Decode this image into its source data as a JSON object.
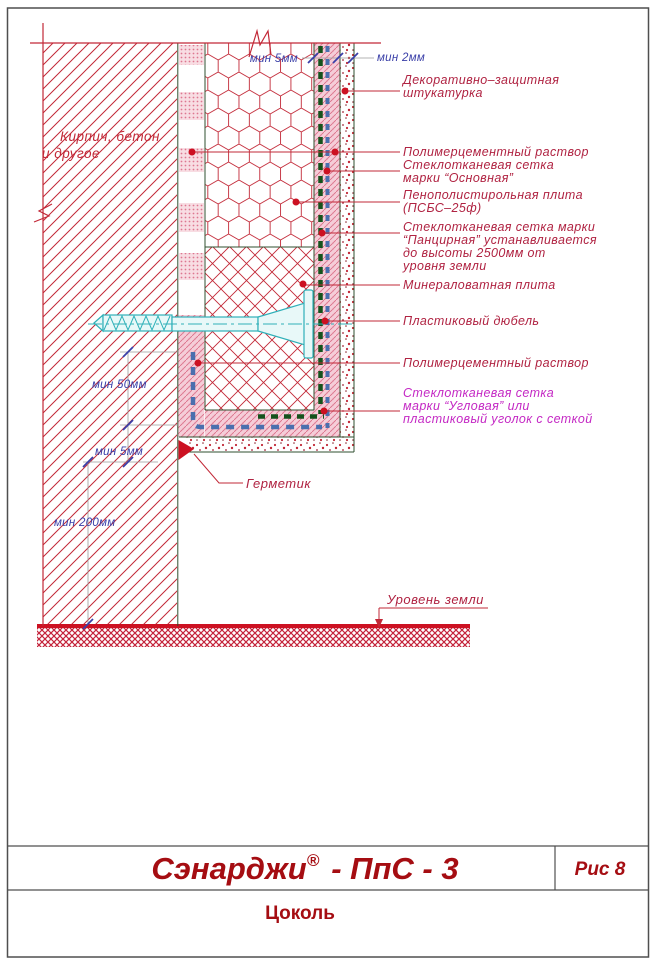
{
  "page": {
    "bg": "#ffffff",
    "border_color": "#4f4f4f"
  },
  "colors": {
    "drawing_red": "#c22837",
    "label_red": "#b02342",
    "label_magenta": "#c428c4",
    "dim_blue": "#3a3fa8",
    "mesh_green": "#15521c",
    "mesh_blue": "#4a6fae",
    "dowel_cyan": "#2fb0b8",
    "ground_red": "#cc1122",
    "title_red": "#a50d12"
  },
  "wall": {
    "label_line1": "Кирпич, бетон",
    "label_line2": "и другое"
  },
  "dimensions": {
    "top_mortar": "мин 5мм",
    "top_stucco": "мин 2мм",
    "side_50": "мин 50мм",
    "side_5": "мин 5мм",
    "side_200": "мин 200мм"
  },
  "annotations": [
    {
      "id": "stucco",
      "lines": [
        "Декоративно–защитная",
        "штукатурка"
      ]
    },
    {
      "id": "mortar-outer",
      "lines": [
        "Полимерцементный раствор"
      ]
    },
    {
      "id": "mesh-main",
      "lines": [
        "Стеклотканевая сетка",
        "марки “Основная”"
      ]
    },
    {
      "id": "foam-plate",
      "lines": [
        "Пенополистирольная плита",
        "(ПСБС–25ф)"
      ]
    },
    {
      "id": "mesh-armor",
      "lines": [
        "Стеклотканевая сетка марки",
        "“Панцирная” устанавливается",
        "до высоты 2500мм от",
        "уровня земли"
      ]
    },
    {
      "id": "mineral-wool",
      "lines": [
        "Минераловатная плита"
      ]
    },
    {
      "id": "dowel",
      "lines": [
        "Пластиковый дюбель"
      ]
    },
    {
      "id": "mortar-bottom",
      "lines": [
        "Полимерцементный раствор"
      ]
    },
    {
      "id": "mesh-corner",
      "lines": [
        "Стеклотканевая сетка",
        "марки “Угловая” или",
        "пластиковый уголок с сеткой"
      ]
    }
  ],
  "callouts": {
    "sealant": "Герметик",
    "ground_level": "Уровень земли"
  },
  "title_block": {
    "brand": "Сэнарджи",
    "reg": "®",
    "series": "- ПпС - 3",
    "fig": "Рис 8",
    "subtitle": "Цоколь"
  }
}
